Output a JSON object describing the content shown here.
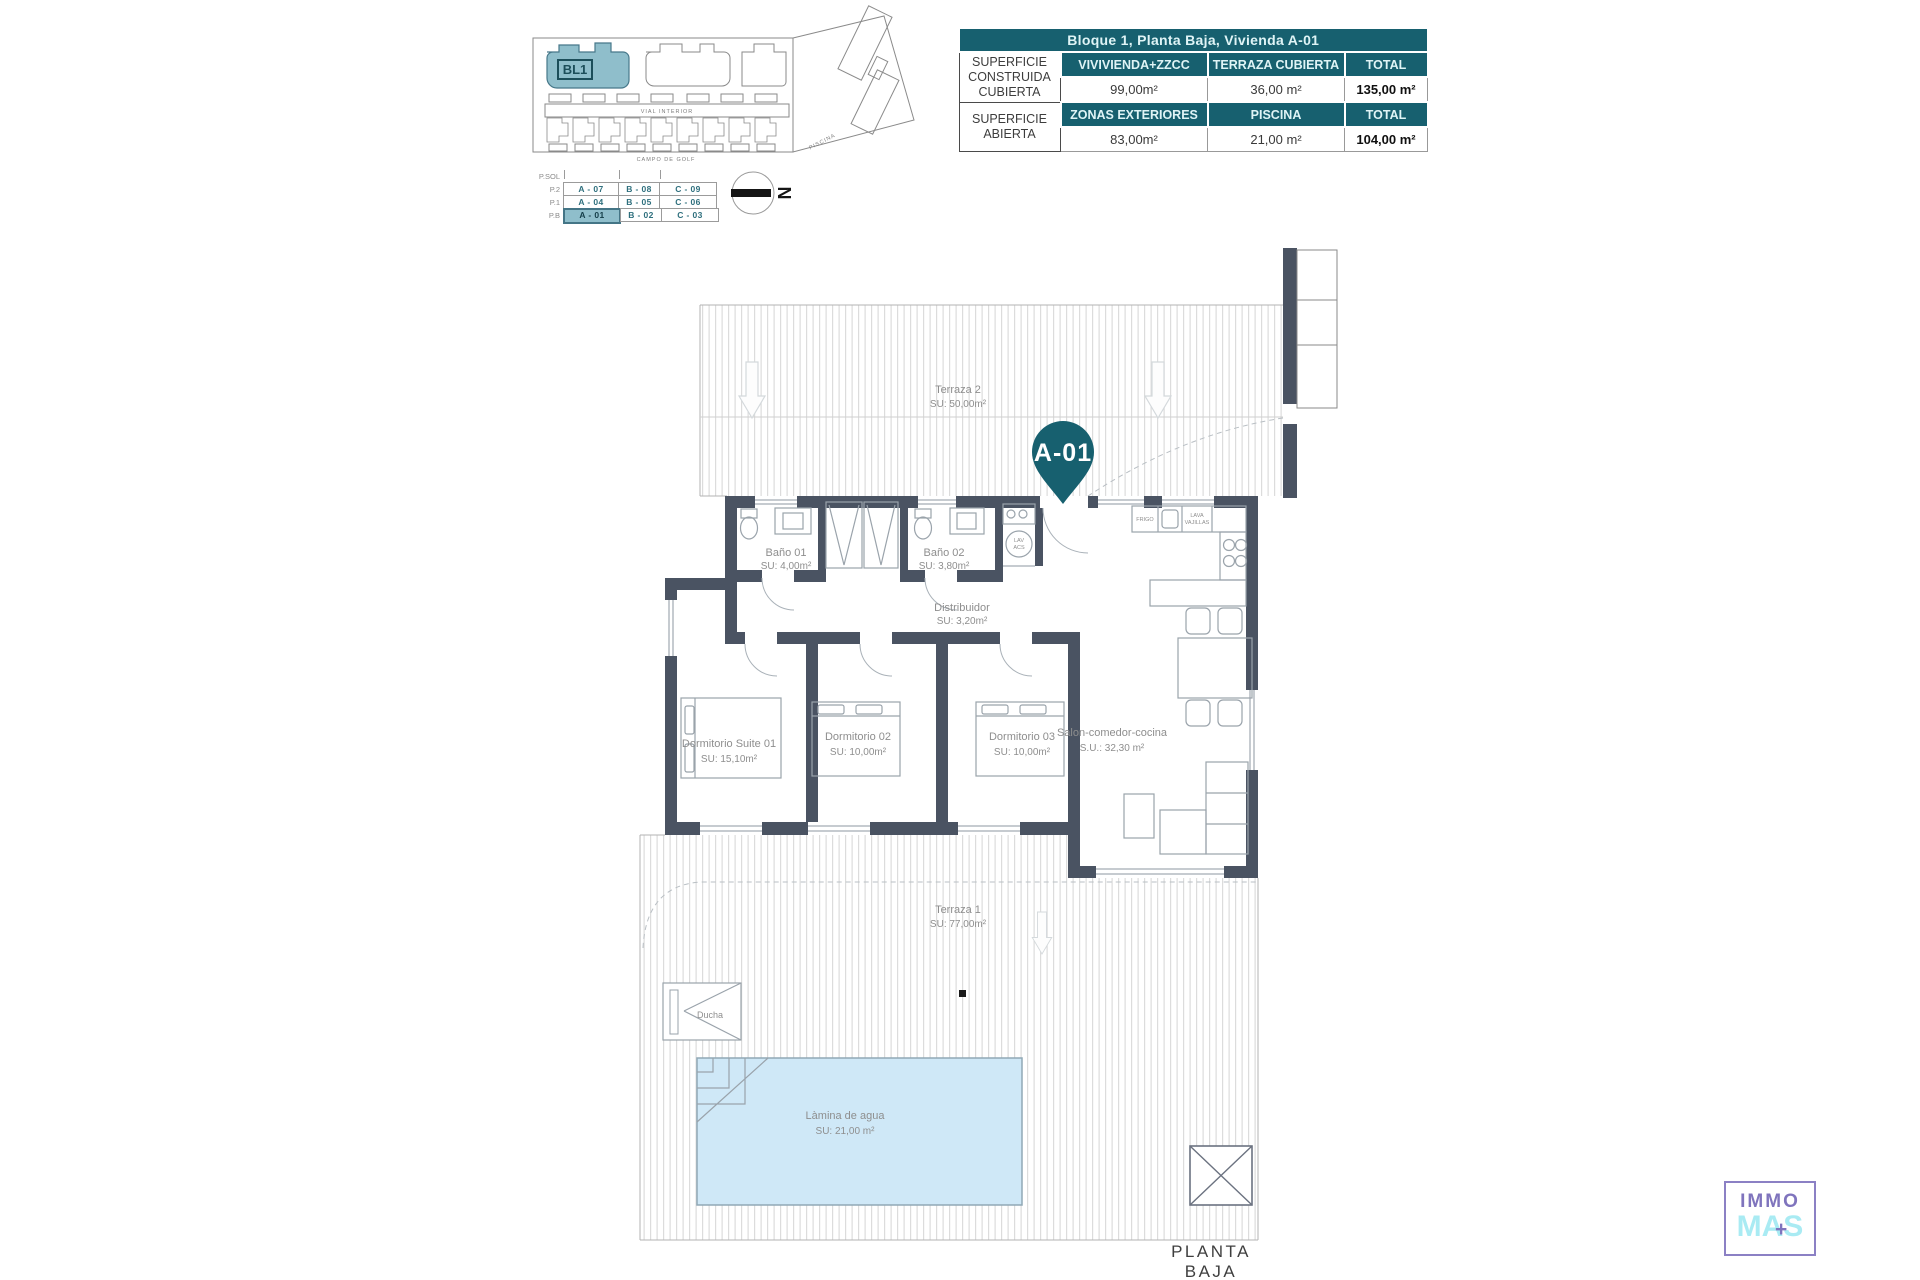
{
  "summary_table": {
    "title": "Bloque 1, Planta Baja, Vivienda A-01",
    "row1": {
      "label": "SUPERFICIE CONSTRUIDA CUBIERTA",
      "col1": "VIVIVIENDA+ZZCC",
      "col2": "TERRAZA CUBIERTA",
      "col3": "TOTAL",
      "val1": "99,00m²",
      "val2": "36,00 m²",
      "val3": "135,00 m²"
    },
    "row2": {
      "label": "SUPERFICIE ABIERTA",
      "col1": "ZONAS EXTERIORES",
      "col2": "PISCINA",
      "col3": "TOTAL",
      "val1": "83,00m²",
      "val2": "21,00 m²",
      "val3": "104,00 m²"
    }
  },
  "site_plan": {
    "block_label": "BL1",
    "road_label": "VIAL INTERIOR",
    "bottom_label": "CAMPO DE GOLF",
    "right_label": "PISCINA"
  },
  "unit_matrix": {
    "header": "P.SOL",
    "row_labels": [
      "P.2",
      "P.1",
      "P.B"
    ],
    "cells": [
      [
        "A - 07",
        "B - 08",
        "C - 09"
      ],
      [
        "A - 04",
        "B - 05",
        "C - 06"
      ],
      [
        "A - 01",
        "B - 02",
        "C - 03"
      ]
    ],
    "highlighted": "A - 01"
  },
  "north": {
    "letter": "N"
  },
  "plan": {
    "pin": "A-01",
    "terraza2": {
      "name": "Terraza 2",
      "area": "SU: 50,00m²"
    },
    "terraza1": {
      "name": "Terraza 1",
      "area": "SU: 77,00m²"
    },
    "bano1": {
      "name": "Baño 01",
      "area": "SU: 4,00m²"
    },
    "bano2": {
      "name": "Baño 02",
      "area": "SU: 3,80m²"
    },
    "distribuidor": {
      "name": "Distribuidor",
      "area": "SU: 3,20m²"
    },
    "suite": {
      "name": "Dormitorio Suite 01",
      "area": "SU: 15,10m²"
    },
    "dorm2": {
      "name": "Dormitorio 02",
      "area": "SU: 10,00m²"
    },
    "dorm3": {
      "name": "Dormitorio 03",
      "area": "SU: 10,00m²"
    },
    "salon": {
      "name": "Salon-comedor-cocina",
      "area": "S.U.: 32,30 m²"
    },
    "pool": {
      "name": "Làmina de agua",
      "area": "SU: 21,00 m²"
    },
    "ducha": "Ducha",
    "lav": "LAV",
    "acs": "ACS",
    "frigo": "FRIGO",
    "lava1": "LAVA",
    "lava2": "VAJILLAS"
  },
  "footer": {
    "title": "PLANTA BAJA"
  },
  "logo": {
    "top": "IMMO",
    "bottom": "MAS",
    "plus": "+"
  },
  "colors": {
    "teal": "#17606F",
    "teal_light": "#8FBECB",
    "wall": "#4A5362",
    "pool_fill": "#CFE8F7",
    "logo_purple": "#7F74BD",
    "logo_cyan": "#A9EBF3"
  }
}
